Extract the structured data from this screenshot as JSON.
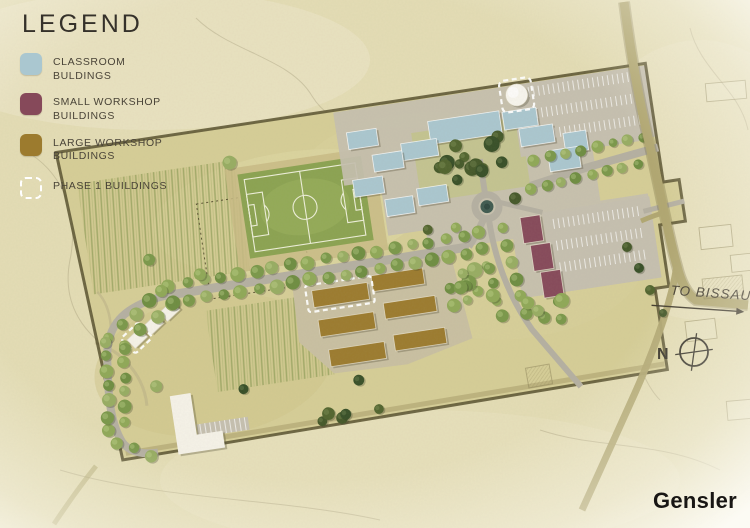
{
  "legend": {
    "title": "LEGEND",
    "items": [
      {
        "id": "classroom",
        "label": "CLASSROOM BULDINGS",
        "swatch": "#aac7d0",
        "swatch_type": "solid"
      },
      {
        "id": "small-workshop",
        "label": "SMALL WORKSHOP BUILDINGS",
        "swatch": "#86495a",
        "swatch_type": "solid"
      },
      {
        "id": "large-workshop",
        "label": "LARGE WORKSHOP BUILDINGS",
        "swatch": "#9c7b2e",
        "swatch_type": "solid"
      },
      {
        "id": "phase1",
        "label": "PHASE 1 BUILDINGS",
        "swatch": "#ffffff",
        "swatch_type": "dashed"
      }
    ]
  },
  "annotations": {
    "to_bissau": "TO BISSAU",
    "north": "N"
  },
  "branding": {
    "logo": "Gensler"
  },
  "palette": {
    "c-bg": "#e4ddb5",
    "c-site": "#d6ce97",
    "c-paving": "#c6c0b0",
    "c-road": "#b5b0a2",
    "c-gravel": "#c9c0a2",
    "c-extroad": "#b1a771",
    "c-boundary": "#57502e",
    "c-field": "#8ba351",
    "c-classroom": "#aac7d0",
    "c-small": "#86495a",
    "c-large": "#9c7b2e",
    "c-white-bldg": "#f6f3e9",
    "c-ink": "#3c3831"
  },
  "site": {
    "rotation_deg": -8.6,
    "tree_colors": {
      "light": [
        "#8fa857",
        "#7a984a",
        "#97ad62",
        "#6e8d41"
      ],
      "dark": [
        "#445829",
        "#374f27",
        "#51642e"
      ]
    },
    "buildings": {
      "classroom": [
        {
          "x": 448,
          "y": 131,
          "w": 72,
          "h": 23
        },
        {
          "x": 418,
          "y": 149,
          "w": 36,
          "h": 17
        },
        {
          "x": 388,
          "y": 156,
          "w": 30,
          "h": 17
        },
        {
          "x": 366,
          "y": 130,
          "w": 30,
          "h": 17
        },
        {
          "x": 365,
          "y": 178,
          "w": 30,
          "h": 17
        },
        {
          "x": 523,
          "y": 133,
          "w": 34,
          "h": 18
        },
        {
          "x": 537,
          "y": 152,
          "w": 34,
          "h": 18
        },
        {
          "x": 580,
          "y": 163,
          "w": 23,
          "h": 20
        },
        {
          "x": 562,
          "y": 178,
          "w": 31,
          "h": 21
        },
        {
          "x": 427,
          "y": 196,
          "w": 30,
          "h": 17
        },
        {
          "x": 394,
          "y": 202,
          "w": 28,
          "h": 17
        }
      ],
      "large_workshop": [
        {
          "x": 308,
          "y": 281,
          "w": 56,
          "h": 17
        },
        {
          "x": 310,
          "y": 311,
          "w": 56,
          "h": 17
        },
        {
          "x": 316,
          "y": 342,
          "w": 56,
          "h": 17
        },
        {
          "x": 369,
          "y": 275,
          "w": 52,
          "h": 16
        },
        {
          "x": 377,
          "y": 304,
          "w": 52,
          "h": 16
        },
        {
          "x": 382,
          "y": 337,
          "w": 52,
          "h": 16
        }
      ],
      "small_workshop": [
        {
          "x": 525,
          "y": 240,
          "w": 20,
          "h": 26
        },
        {
          "x": 531,
          "y": 269,
          "w": 20,
          "h": 26
        },
        {
          "x": 537,
          "y": 297,
          "w": 20,
          "h": 26
        }
      ],
      "white": [
        {
          "x": 120,
          "y": 296,
          "w": 17,
          "h": 12,
          "rot": -35
        },
        {
          "x": 138,
          "y": 285,
          "w": 17,
          "h": 12,
          "rot": -35
        },
        {
          "x": 156,
          "y": 274,
          "w": 17,
          "h": 12,
          "rot": -35
        }
      ]
    },
    "phase1_outlines": [
      {
        "x": 524,
        "y": 102,
        "w": 32,
        "h": 32,
        "rx": 5
      },
      {
        "x": 302,
        "y": 275,
        "w": 67,
        "h": 27,
        "rx": 3
      },
      {
        "x": 116,
        "y": 291,
        "w": 24,
        "h": 21,
        "rx": 3,
        "rot": -35
      }
    ],
    "tree_rows": [
      {
        "x1": 168,
        "y1": 254,
        "x2": 466,
        "y2": 250,
        "n": 18,
        "r": 6
      },
      {
        "x1": 168,
        "y1": 272,
        "x2": 466,
        "y2": 268,
        "n": 18,
        "r": 6
      },
      {
        "x1": 100,
        "y1": 296,
        "x2": 160,
        "y2": 258,
        "n": 5,
        "r": 6
      },
      {
        "x1": 116,
        "y1": 306,
        "x2": 168,
        "y2": 272,
        "n": 4,
        "r": 6
      },
      {
        "x1": 86,
        "y1": 390,
        "x2": 98,
        "y2": 300,
        "n": 7,
        "r": 6
      },
      {
        "x1": 104,
        "y1": 382,
        "x2": 114,
        "y2": 310,
        "n": 6,
        "r": 6
      },
      {
        "x1": 92,
        "y1": 402,
        "x2": 126,
        "y2": 420,
        "n": 3,
        "r": 6
      },
      {
        "x1": 548,
        "y1": 186,
        "x2": 660,
        "y2": 178,
        "n": 8,
        "r": 5
      },
      {
        "x1": 540,
        "y1": 212,
        "x2": 650,
        "y2": 206,
        "n": 8,
        "r": 5
      },
      {
        "x1": 482,
        "y1": 248,
        "x2": 492,
        "y2": 335,
        "n": 6,
        "r": 5.5
      },
      {
        "x1": 506,
        "y1": 248,
        "x2": 516,
        "y2": 335,
        "n": 6,
        "r": 5.5
      }
    ],
    "tree_clusters": [
      {
        "cx": 497,
        "cy": 172,
        "n": 9,
        "spread": 27,
        "dark": true
      },
      {
        "cx": 455,
        "cy": 185,
        "n": 5,
        "spread": 20,
        "dark": true
      },
      {
        "cx": 470,
        "cy": 300,
        "n": 11,
        "spread": 33,
        "dark": false
      },
      {
        "cx": 540,
        "cy": 335,
        "n": 6,
        "spread": 24,
        "dark": false
      },
      {
        "cx": 330,
        "cy": 390,
        "n": 6,
        "spread": 36,
        "dark": true
      }
    ],
    "tree_singles": [
      {
        "x": 200,
        "y": 248,
        "r": 6,
        "dark": false
      },
      {
        "x": 152,
        "y": 226,
        "r": 6,
        "dark": false
      },
      {
        "x": 246,
        "y": 142,
        "r": 7,
        "dark": false
      },
      {
        "x": 523,
        "y": 220,
        "r": 6,
        "dark": true
      },
      {
        "x": 460,
        "y": 240,
        "r": 5,
        "dark": false
      },
      {
        "x": 432,
        "y": 238,
        "r": 5,
        "dark": true
      },
      {
        "x": 140,
        "y": 352,
        "r": 6,
        "dark": false
      },
      {
        "x": 226,
        "y": 368,
        "r": 5,
        "dark": true
      }
    ],
    "external_trees": [
      {
        "x": 627,
        "y": 247,
        "r": 5
      },
      {
        "x": 639,
        "y": 268,
        "r": 5
      },
      {
        "x": 650,
        "y": 290,
        "r": 5
      },
      {
        "x": 663,
        "y": 313,
        "r": 4
      }
    ]
  }
}
